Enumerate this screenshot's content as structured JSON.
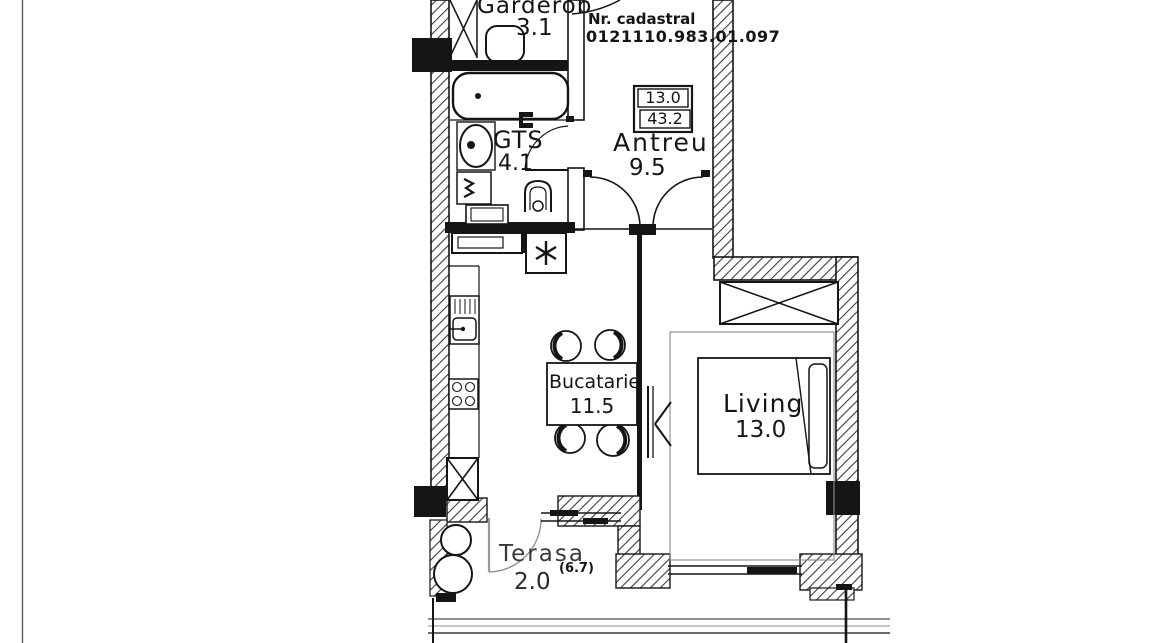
{
  "document": {
    "kind": "apartment-floor-plan-scan",
    "cadastral": {
      "label": "Nr. cadastral",
      "number": "0121110.983.01.097"
    },
    "area_table": {
      "upper": "13.0",
      "lower": "43.2"
    }
  },
  "rooms": [
    {
      "id": "garderob",
      "name": "Garderob",
      "area": "3.1",
      "fixtures": [
        "wardrobe-x-icon",
        "ottoman-icon",
        "door-arc-icon"
      ]
    },
    {
      "id": "gts",
      "name": "GTS",
      "area": "4.1",
      "fixtures": [
        "bathtub-icon",
        "washbasin-icon",
        "washing-machine-icon",
        "toilet-icon",
        "door-arc-icon",
        "vanity-cabinet-icon"
      ]
    },
    {
      "id": "antreu",
      "name": "Antreu",
      "area": "9.5",
      "fixtures": [
        "door-arc-icon",
        "door-arc-icon",
        "area-table-icon"
      ]
    },
    {
      "id": "bucatarie",
      "name": "Bucatarie",
      "area": "11.5",
      "fixtures": [
        "kitchen-sink-icon",
        "stove-icon",
        "boiler-asterisk-icon",
        "dining-table-icon",
        "chair-icon",
        "chair-icon",
        "chair-icon",
        "chair-icon",
        "cabinet-x-icon"
      ]
    },
    {
      "id": "living",
      "name": "Living",
      "area": "13.0",
      "fixtures": [
        "wardrobe-x-icon",
        "bed-icon",
        "tv-bracket-icon",
        "window-icon",
        "column-icon"
      ]
    },
    {
      "id": "terasa",
      "name": "Terasa",
      "area": "2.0",
      "area_total": "(6.7)",
      "fixtures": [
        "door-arc-icon",
        "sliding-window-icon",
        "column-round-icon",
        "column-round-icon"
      ]
    }
  ],
  "colors": {
    "ink": "#151515",
    "paper": "#ffffff",
    "wall_hatch": "#3d3d3d",
    "faint_line": "#8c8c8c",
    "door_gray": "#9a9a9a"
  }
}
